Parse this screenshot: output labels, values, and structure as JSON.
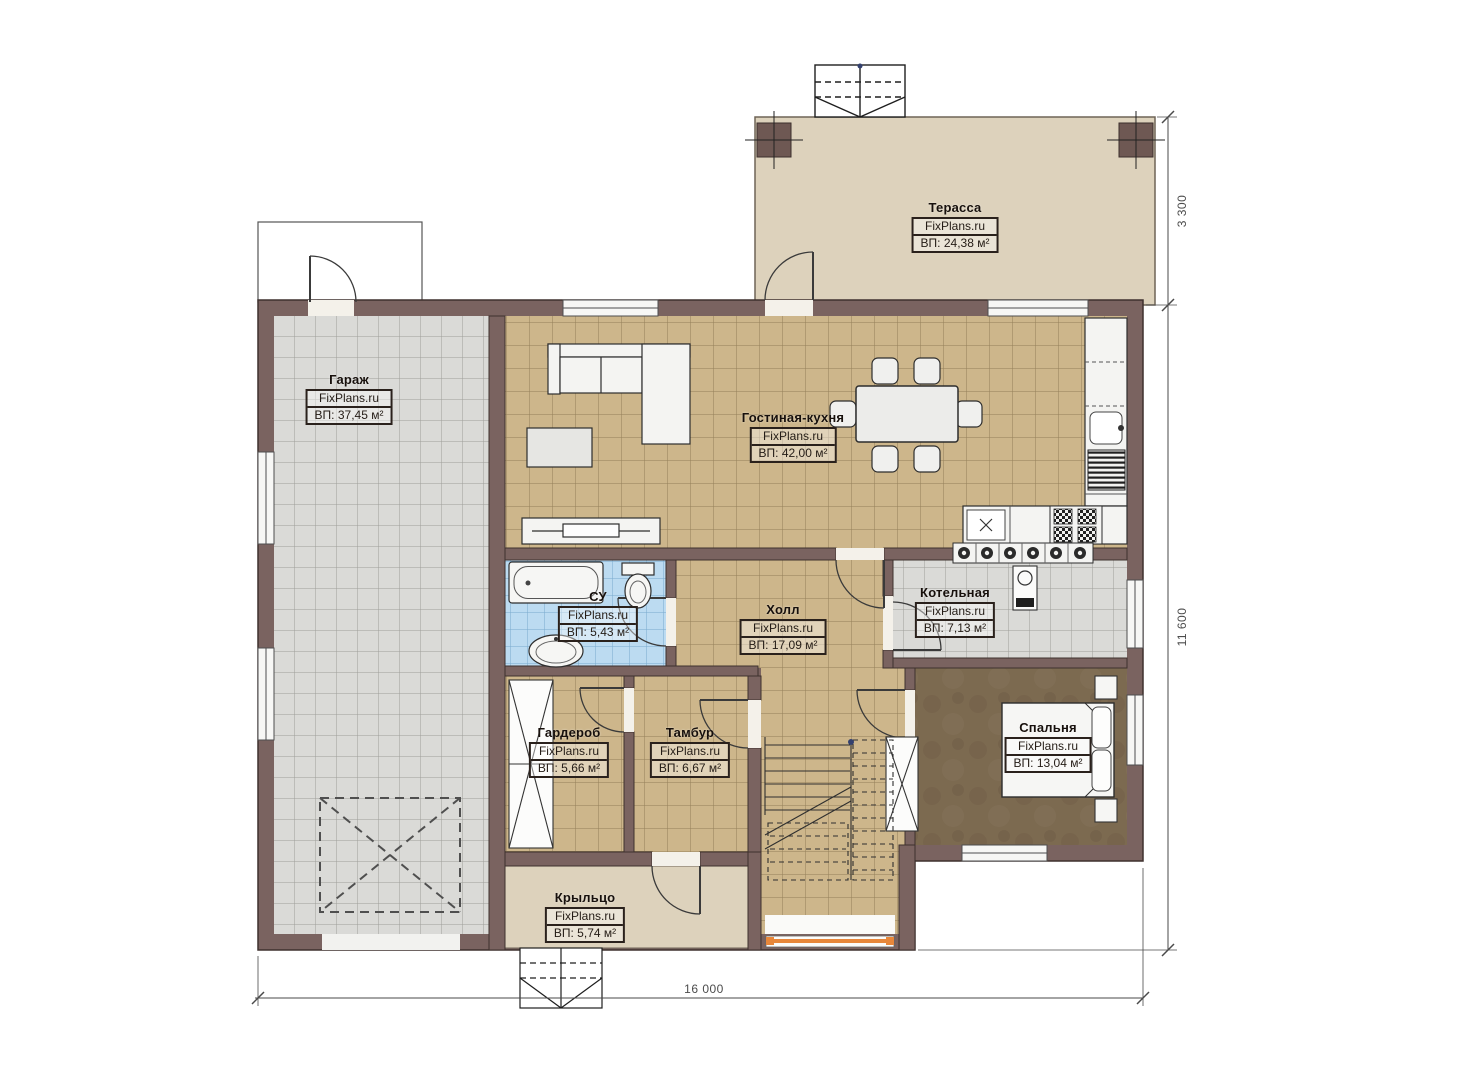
{
  "plan": {
    "watermark": "FixPlans.ru",
    "rooms": [
      {
        "name": "Терасса",
        "area": "ВП: 24,38 м²"
      },
      {
        "name": "Гараж",
        "area": "ВП: 37,45 м²"
      },
      {
        "name": "Гостиная-кухня",
        "area": "ВП: 42,00 м²"
      },
      {
        "name": "СУ",
        "area": "ВП: 5,43 м²"
      },
      {
        "name": "Холл",
        "area": "ВП: 17,09 м²"
      },
      {
        "name": "Котельная",
        "area": "ВП: 7,13 м²"
      },
      {
        "name": "Гардероб",
        "area": "ВП: 5,66 м²"
      },
      {
        "name": "Тамбур",
        "area": "ВП: 6,67 м²"
      },
      {
        "name": "Спальня",
        "area": "ВП: 13,04 м²"
      },
      {
        "name": "Крыльцо",
        "area": "ВП: 5,74 м²"
      }
    ],
    "dimensions": {
      "terrace_depth": "3 300",
      "house_depth": "11 600",
      "house_width": "16 000"
    },
    "colors": {
      "wall": "#7a6360",
      "tan_floor": "#cdb68b",
      "garage_floor": "#dadad7",
      "bath_floor": "#bcdbf1",
      "bedroom_floor": "#7c6a50",
      "terrace_floor": "#ddd2bc",
      "window_accent_orange": "#e8873a"
    }
  }
}
